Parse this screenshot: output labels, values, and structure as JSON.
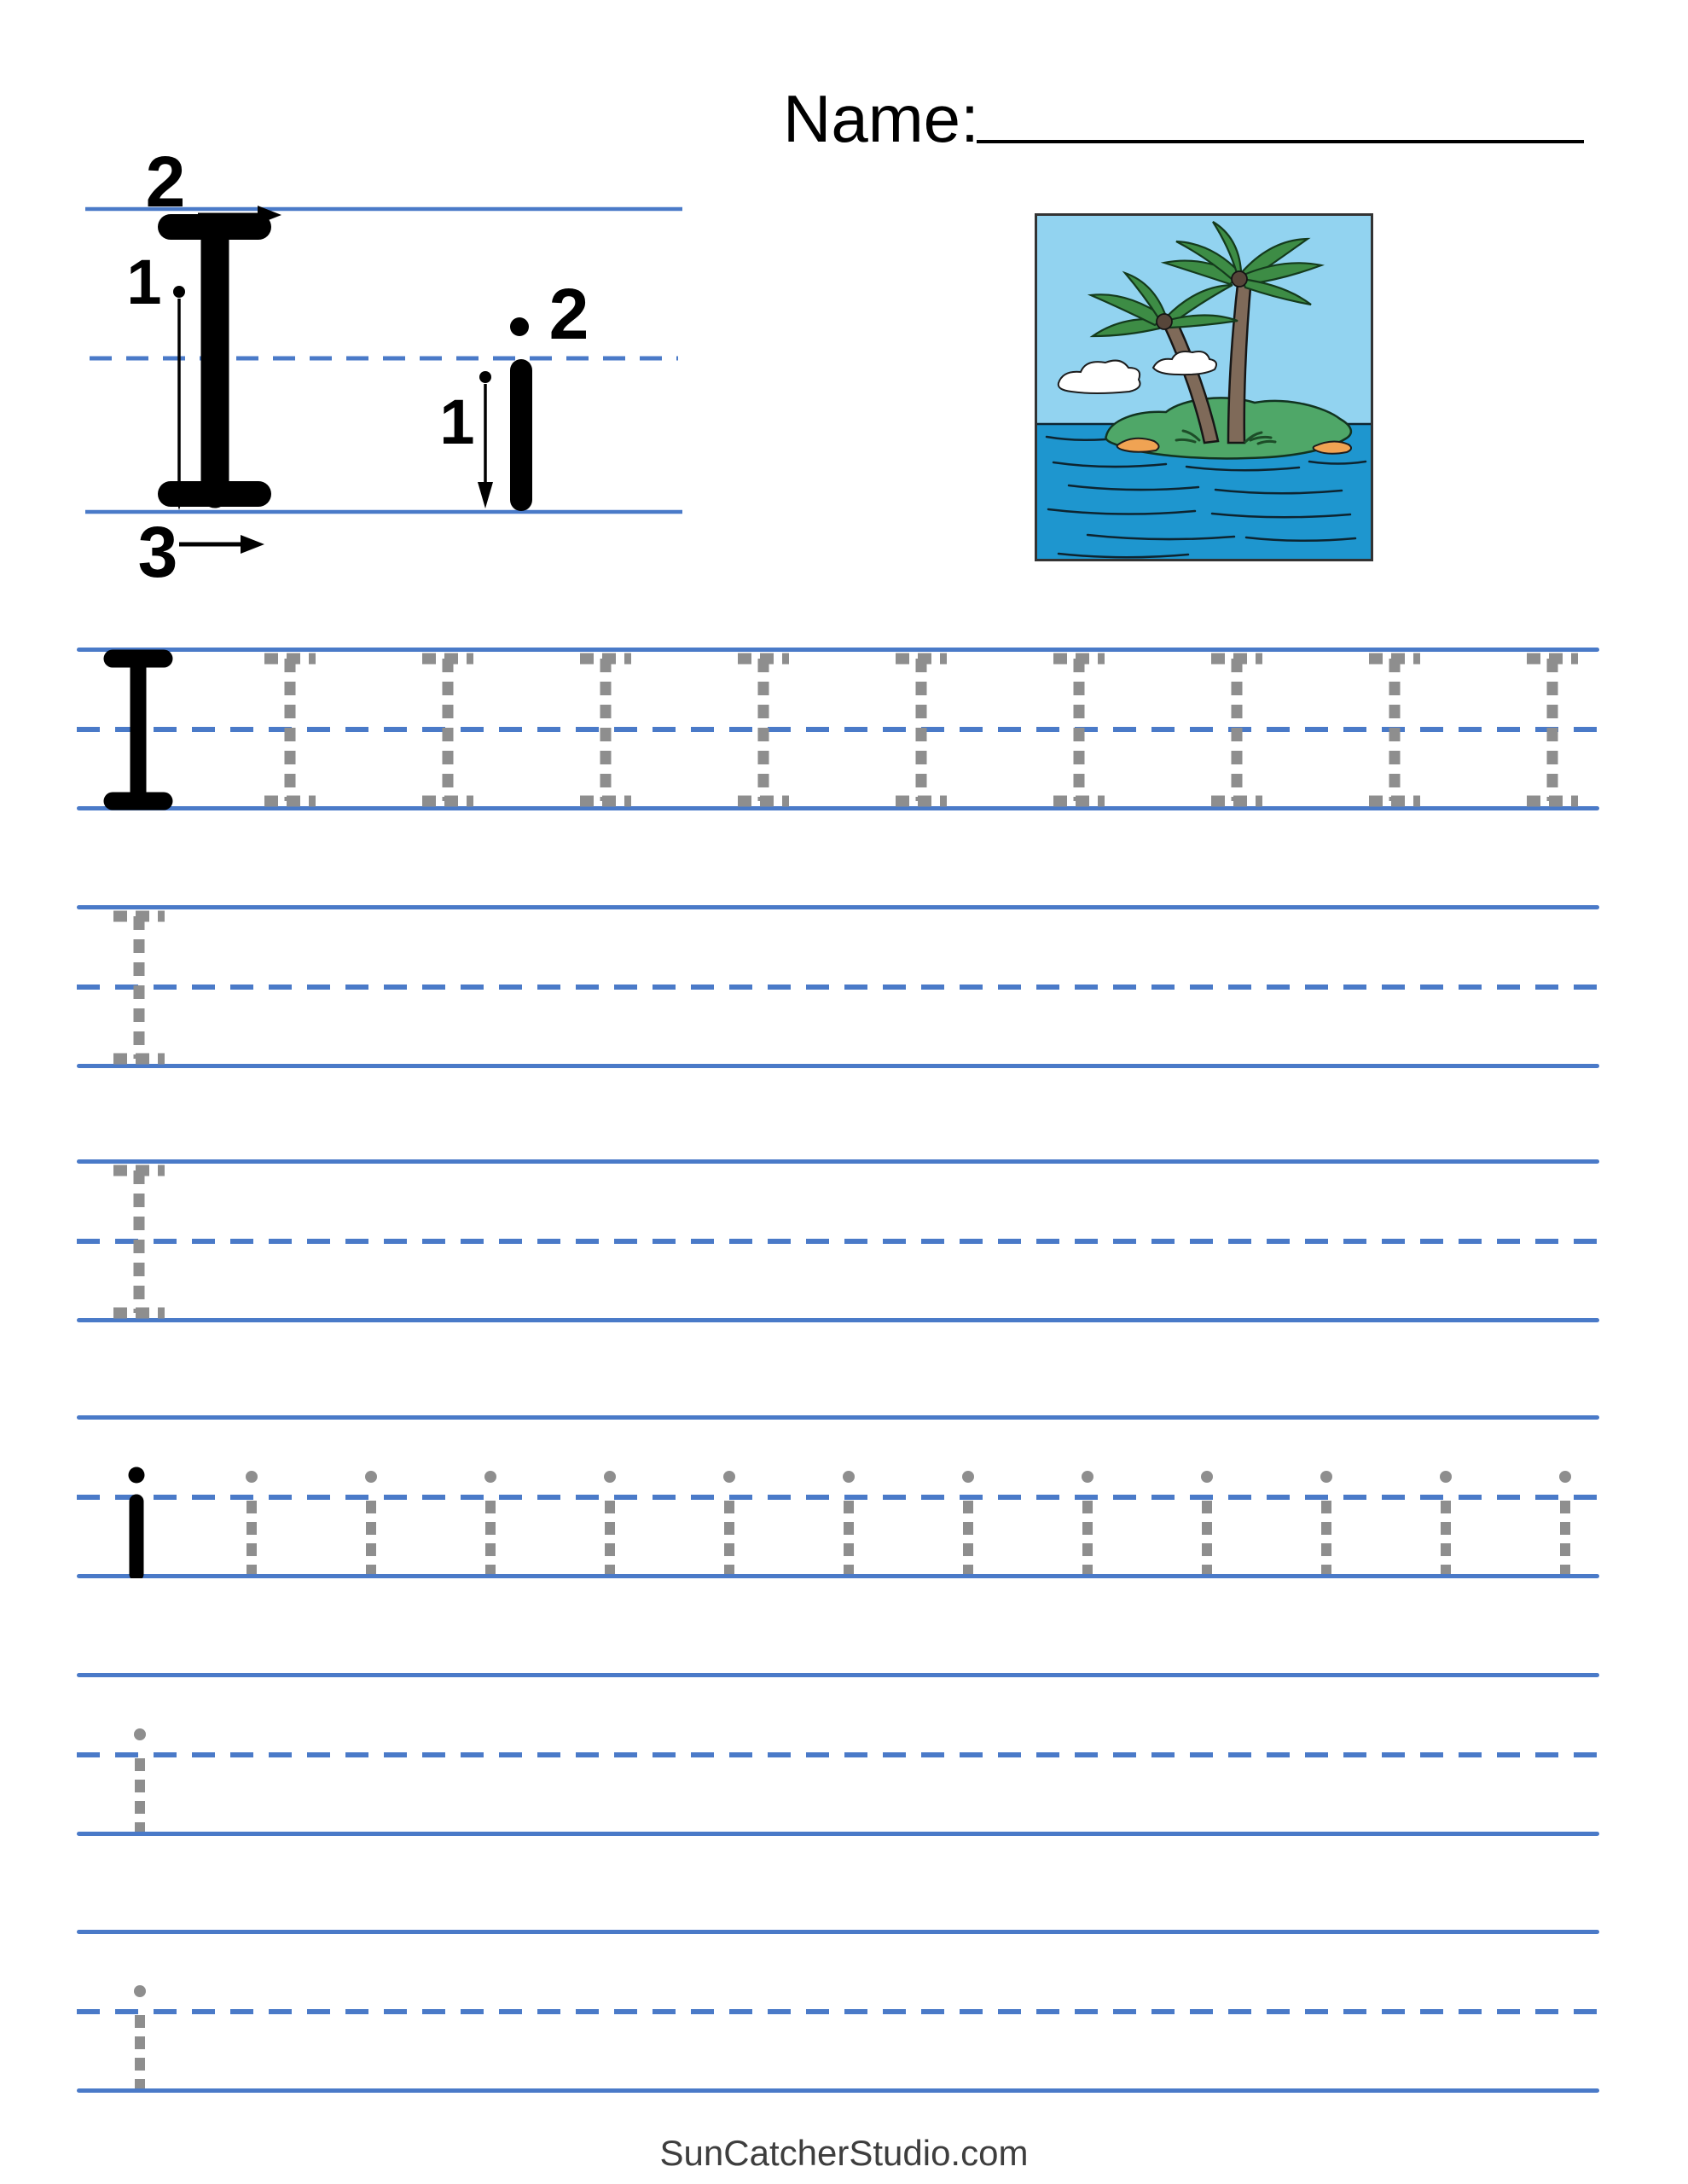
{
  "header": {
    "name_label": "Name:"
  },
  "guide": {
    "upper_letter": "I",
    "lower_letter": "i",
    "upper_step_stem": "1",
    "upper_step_top": "2",
    "upper_step_bottom": "3",
    "lower_step_stem": "1",
    "lower_step_dot": "2"
  },
  "illustration": {
    "subject": "island with two palm trees in the ocean"
  },
  "practice_rows": [
    {
      "name": "uppercase-model-row",
      "style": "upper",
      "solid": 1,
      "dashed": 9
    },
    {
      "name": "uppercase-blank-row-1",
      "style": "upper",
      "solid": 0,
      "dashed": 1
    },
    {
      "name": "uppercase-blank-row-2",
      "style": "upper",
      "solid": 0,
      "dashed": 1
    },
    {
      "name": "lowercase-model-row",
      "style": "lower",
      "solid": 1,
      "dashed": 12
    },
    {
      "name": "lowercase-blank-row-1",
      "style": "lower",
      "solid": 0,
      "dashed": 1
    },
    {
      "name": "lowercase-blank-row-2",
      "style": "lower",
      "solid": 0,
      "dashed": 1
    }
  ],
  "footer": {
    "site": "SunCatcherStudio.com"
  },
  "colors": {
    "line_blue": "#4a7ac8",
    "trace_gray": "#8e8e8e",
    "ink": "#000000"
  }
}
